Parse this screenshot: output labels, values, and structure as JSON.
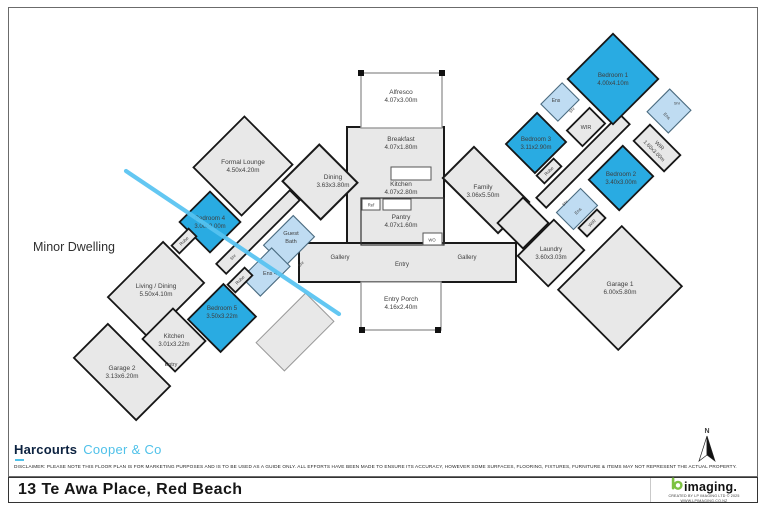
{
  "plan": {
    "minor_dwelling_label": "Minor Dwelling",
    "north_label": "N",
    "colors": {
      "room_fill": "#e8e8e8",
      "bedroom_fill": "#29abe2",
      "bath_fill": "#bfdcf2",
      "wall": "#1a1a1a",
      "divider_line": "#56c3f1"
    },
    "rooms": [
      {
        "id": "hall-left",
        "cx": 258,
        "cy": 232,
        "w": 104,
        "h": 14,
        "rot": -45,
        "fill": "room"
      },
      {
        "id": "formal-lounge",
        "l1": "Formal Lounge",
        "l2": "4.50x4.20m",
        "cx": 243,
        "cy": 166,
        "w": 72,
        "h": 68,
        "rot": -45,
        "fill": "room"
      },
      {
        "id": "living-dining",
        "l1": "Living / Dining",
        "l2": "5.50x4.10m",
        "cx": 156,
        "cy": 290,
        "w": 78,
        "h": 58,
        "rot": -45,
        "fill": "room"
      },
      {
        "id": "kitchen-minor",
        "l1": "Kitchen",
        "l2": "3.01x3.22m",
        "cx": 174,
        "cy": 340,
        "w": 43,
        "h": 46,
        "rot": -45,
        "fill": "room",
        "fs": 6.2
      },
      {
        "id": "garage-2",
        "l1": "Garage 2",
        "l2": "3.13x6.20m",
        "cx": 122,
        "cy": 372,
        "w": 48,
        "h": 88,
        "rot": -45,
        "fill": "room"
      },
      {
        "id": "veranda",
        "cx": 295,
        "cy": 332,
        "w": 70,
        "h": 40,
        "rot": -45,
        "fill": "room",
        "light": true
      },
      {
        "id": "bedroom-4",
        "l1": "Bedroom 4",
        "l2": "3.00x3.00m",
        "cx": 210,
        "cy": 222,
        "w": 43,
        "h": 43,
        "rot": -45,
        "fill": "bed",
        "fs": 6.2
      },
      {
        "id": "bedroom-5",
        "l1": "Bedroom 5",
        "l2": "3.50x3.22m",
        "cx": 222,
        "cy": 318,
        "w": 50,
        "h": 46,
        "rot": -45,
        "fill": "bed",
        "fs": 6.2,
        "ly": 312
      },
      {
        "id": "guest-bath",
        "l1": "Guest",
        "l2": "Bath",
        "cx": 289,
        "cy": 241,
        "w": 42,
        "h": 30,
        "rot": -45,
        "fill": "bath",
        "fs": 5.8,
        "lx": 291,
        "ly": 237
      },
      {
        "id": "ens-4",
        "l1": "Ens 4",
        "cx": 266,
        "cy": 272,
        "w": 42,
        "h": 26,
        "rot": -45,
        "fill": "bath",
        "fs": 5.5,
        "lx": 270,
        "ly": 273
      },
      {
        "id": "robe-bed4",
        "l1": "Robe",
        "cx": 184,
        "cy": 241,
        "w": 24,
        "h": 11,
        "rot": -45,
        "fill": "room",
        "fs": 4.5,
        "lrot": -45
      },
      {
        "id": "robe-bed5",
        "l1": "Robe",
        "cx": 240,
        "cy": 280,
        "w": 24,
        "h": 11,
        "rot": -45,
        "fill": "room",
        "fs": 4.5,
        "lrot": -45
      },
      {
        "id": "shr-guest",
        "l1": "Shr",
        "cx": 233,
        "cy": 257,
        "fs": 4.2,
        "lrot": -45
      },
      {
        "id": "shr-ens4",
        "l1": "Shr",
        "cx": 301,
        "cy": 264,
        "fs": 4.2,
        "lrot": -45
      },
      {
        "id": "entry-minor",
        "l1": "Entry",
        "cx": 171,
        "cy": 364,
        "fs": 5.5
      },
      {
        "id": "hall-right",
        "cx": 583,
        "cy": 161,
        "w": 118,
        "h": 14,
        "rot": -45,
        "fill": "room"
      },
      {
        "id": "junction-right",
        "cx": 523,
        "cy": 223,
        "w": 36,
        "h": 36,
        "rot": -45,
        "fill": "room"
      },
      {
        "id": "laundry",
        "l1": "Laundry",
        "l2": "3.60x3.03m",
        "cx": 551,
        "cy": 253,
        "w": 51,
        "h": 43,
        "rot": -45,
        "fill": "room",
        "fs": 6.2
      },
      {
        "id": "garage-1",
        "l1": "Garage 1",
        "l2": "6.00x5.80m",
        "cx": 620,
        "cy": 288,
        "w": 90,
        "h": 85,
        "rot": -45,
        "fill": "room"
      },
      {
        "id": "bedroom-1",
        "l1": "Bedroom 1",
        "l2": "4.00x4.10m",
        "cx": 613,
        "cy": 79,
        "w": 64,
        "h": 64,
        "rot": -45,
        "fill": "bed",
        "fs": 6.2
      },
      {
        "id": "bedroom-3",
        "l1": "Bedroom 3",
        "l2": "3.11x2.90m",
        "cx": 536,
        "cy": 143,
        "w": 44,
        "h": 41,
        "rot": -45,
        "fill": "bed",
        "fs": 6.2
      },
      {
        "id": "bedroom-2",
        "l1": "Bedroom 2",
        "l2": "3.40x3.00m",
        "cx": 621,
        "cy": 178,
        "w": 48,
        "h": 43,
        "rot": -45,
        "fill": "bed",
        "fs": 6.2
      },
      {
        "id": "ens-1",
        "l1": "Ens",
        "cx": 560,
        "cy": 102,
        "w": 30,
        "h": 24,
        "rot": -45,
        "fill": "bath",
        "fs": 5,
        "lx": 556,
        "ly": 100
      },
      {
        "id": "shr-ens1",
        "l1": "Shr",
        "cx": 572,
        "cy": 110,
        "fs": 4,
        "lrot": -45
      },
      {
        "id": "wir-1",
        "l1": "WIR",
        "cx": 586,
        "cy": 127,
        "w": 32,
        "h": 22,
        "rot": -45,
        "fill": "room",
        "fs": 5.5
      },
      {
        "id": "robe-bed3",
        "l1": "Robe",
        "cx": 549,
        "cy": 171,
        "w": 24,
        "h": 11,
        "rot": -45,
        "fill": "room",
        "fs": 4.5,
        "lrot": -45
      },
      {
        "id": "wir-2",
        "l1": "WIR",
        "l2": "1.60x3.00m",
        "cx": 657,
        "cy": 148,
        "w": 23,
        "h": 43,
        "rot": -45,
        "fill": "room",
        "fs": 5.5,
        "lrot": 45
      },
      {
        "id": "ens-2",
        "l1": "Ens",
        "cx": 669,
        "cy": 111,
        "w": 32,
        "h": 30,
        "rot": -45,
        "fill": "bath",
        "fs": 4.5,
        "lrot": 45,
        "lx": 667,
        "ly": 116
      },
      {
        "id": "shr-ens2",
        "l1": "Shr",
        "cx": 677,
        "cy": 103,
        "fs": 4
      },
      {
        "id": "ens-laundry",
        "l1": "Ens",
        "cx": 577,
        "cy": 209,
        "w": 34,
        "h": 24,
        "rot": -45,
        "fill": "bath",
        "fs": 4.5,
        "lrot": -45,
        "lx": 578,
        "ly": 211
      },
      {
        "id": "shr-ens3",
        "l1": "Shr",
        "cx": 565,
        "cy": 203,
        "fs": 4,
        "lrot": -45
      },
      {
        "id": "wir-3",
        "l1": "WIR",
        "cx": 592,
        "cy": 223,
        "w": 26,
        "h": 12,
        "rot": -45,
        "fill": "room",
        "fs": 4.5,
        "lrot": -45
      },
      {
        "id": "alfresco",
        "l1": "Alfresco",
        "l2": "4.07x3.00m",
        "cx": 401,
        "cy": 96
      },
      {
        "id": "breakfast",
        "l1": "Breakfast",
        "l2": "4.07x1.80m",
        "cx": 401,
        "cy": 143
      },
      {
        "id": "kitchen-main",
        "l1": "Kitchen",
        "l2": "4.07x2.80m",
        "cx": 401,
        "cy": 188
      },
      {
        "id": "pantry",
        "l1": "Pantry",
        "l2": "4.07x1.60m",
        "cx": 401,
        "cy": 221
      },
      {
        "id": "ref",
        "l1": "Ref",
        "cx": 371,
        "cy": 205,
        "fs": 4.2
      },
      {
        "id": "wo",
        "l1": "WO",
        "cx": 432,
        "cy": 240,
        "fs": 4.2
      },
      {
        "id": "dining",
        "l1": "Dining",
        "l2": "3.63x3.80m",
        "cx": 333,
        "cy": 181
      },
      {
        "id": "family",
        "l1": "Family",
        "l2": "3.06x5.50m",
        "cx": 483,
        "cy": 191
      },
      {
        "id": "gallery-left",
        "l1": "Gallery",
        "cx": 340,
        "cy": 257,
        "fs": 6
      },
      {
        "id": "gallery-right",
        "l1": "Gallery",
        "cx": 467,
        "cy": 257,
        "fs": 6
      },
      {
        "id": "entry-main",
        "l1": "Entry",
        "cx": 402,
        "cy": 264,
        "fs": 6
      },
      {
        "id": "entry-porch",
        "l1": "Entry Porch",
        "l2": "4.16x2.40m",
        "cx": 401,
        "cy": 303
      }
    ]
  },
  "footer": {
    "agency": {
      "name": "Harcourts",
      "suffix": "Cooper & Co"
    },
    "disclaimer": "DISCLAIMER: PLEASE NOTE THIS FLOOR PLAN IS FOR MARKETING PURPOSES AND IS TO BE USED AS A GUIDE ONLY. ALL EFFORTS HAVE BEEN MADE TO ENSURE ITS ACCURACY, HOWEVER SOME SURFACES, FLOORING, FIXTURES, FURNITURE & ITEMS MAY NOT REPRESENT THE ACTUAL PROPERTY.",
    "address": "13 Te Awa Place, Red Beach",
    "imaging": {
      "wordmark": "imaging.",
      "credit1": "CREATED BY LP IMAGING LTD © 2025",
      "credit2": "WWW.LPIMAGING.CO.NZ"
    }
  }
}
